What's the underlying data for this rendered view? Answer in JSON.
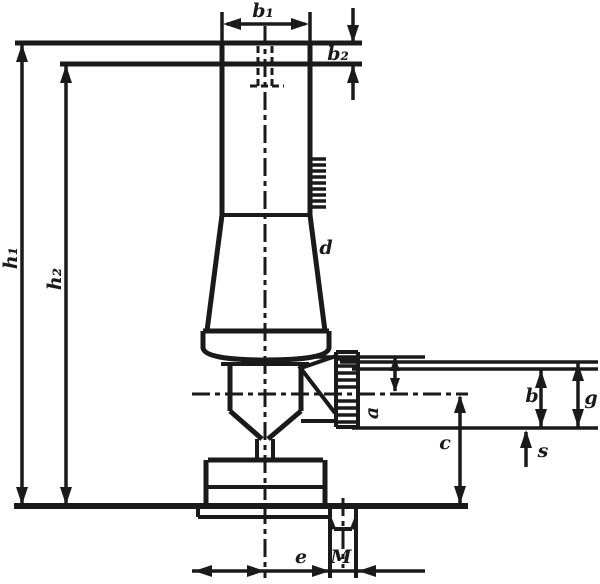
{
  "drawing": {
    "description": "Technical dimension drawing of a floor-standing pillar valve",
    "background_color": "#ffffff",
    "line_color": "#1a1a1a",
    "labels": {
      "b1": "b₁",
      "b2": "b₂",
      "h1": "h₁",
      "h2": "h₂",
      "d": "d",
      "a": "a",
      "b": "b",
      "g": "g",
      "s": "s",
      "c": "c",
      "e": "e",
      "M": "M"
    }
  }
}
